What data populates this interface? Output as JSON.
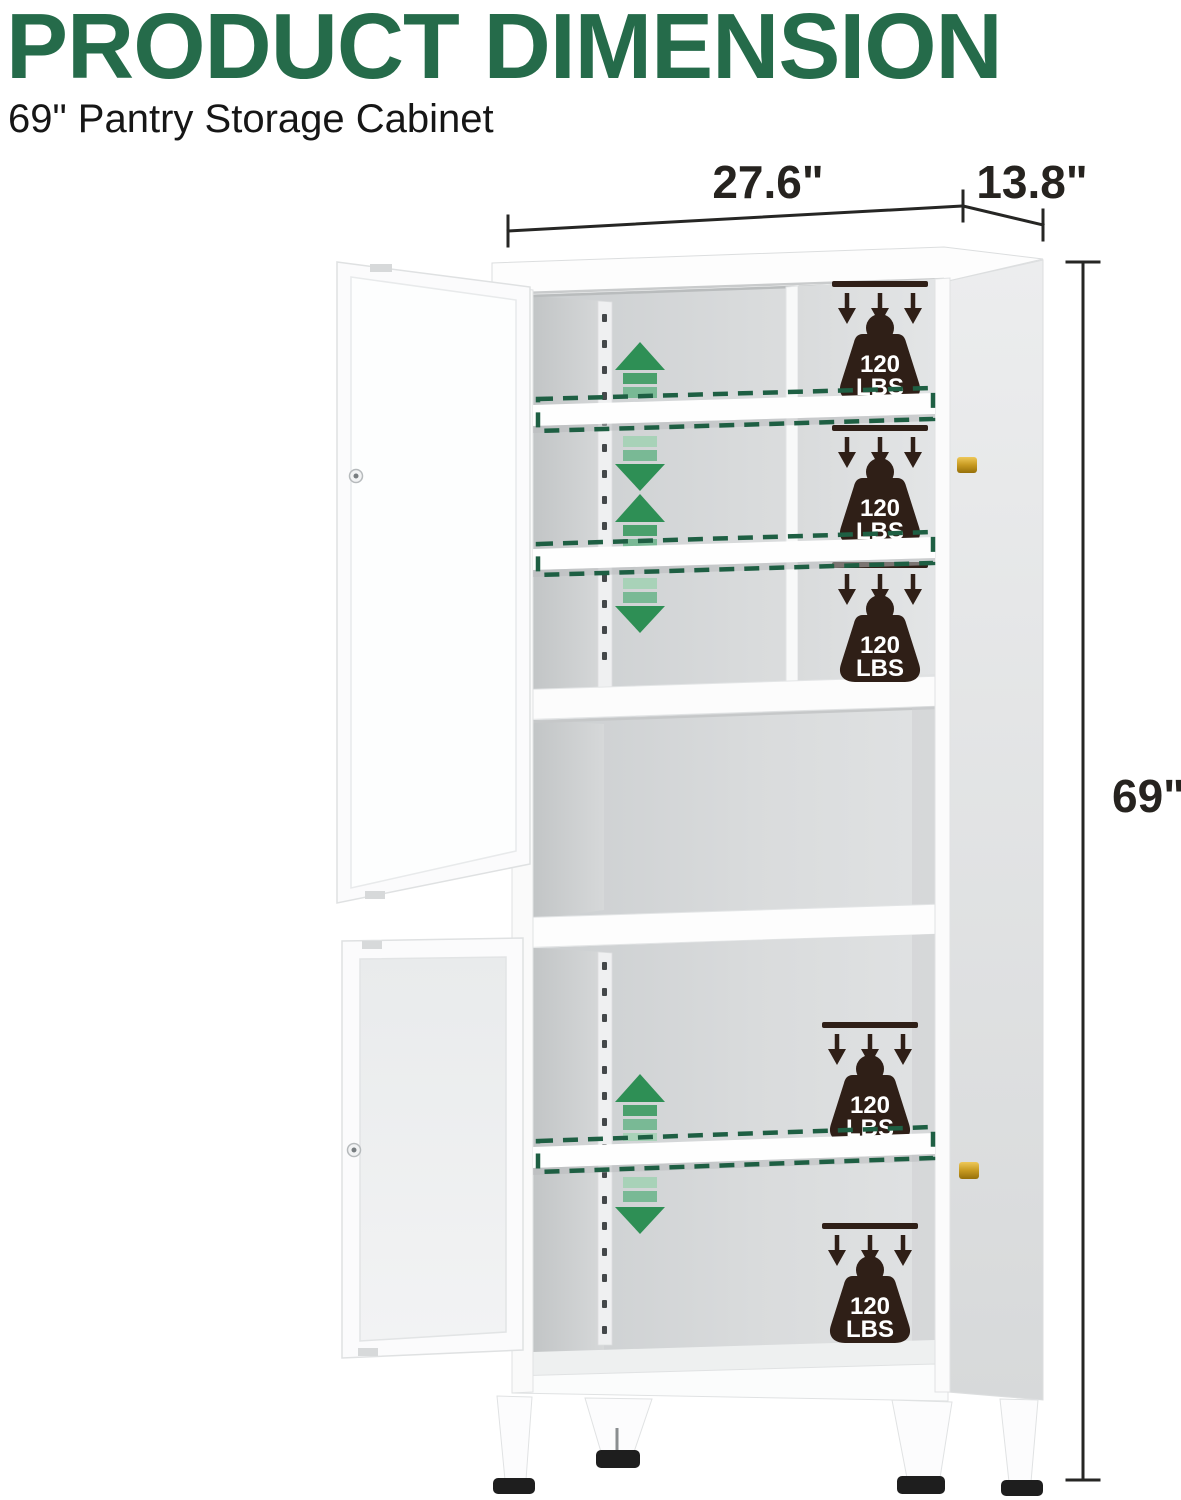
{
  "header": {
    "title": "PRODUCT DIMENSION",
    "subtitle": "69\" Pantry Storage Cabinet"
  },
  "dimensions": {
    "width": "27.6\"",
    "depth": "13.8\"",
    "height": "69\""
  },
  "badge": {
    "line1": "120",
    "line2": "LBS"
  },
  "colors": {
    "title-green": "#256b4a",
    "dash-green": "#1e5f43",
    "g1": "#2e8f55",
    "g2": "#4aa06c",
    "g3": "#79b995",
    "g4": "#a8d2b8",
    "badge-brown": "#2f1f17",
    "dim-line": "#262624",
    "gold": "#c29018"
  }
}
